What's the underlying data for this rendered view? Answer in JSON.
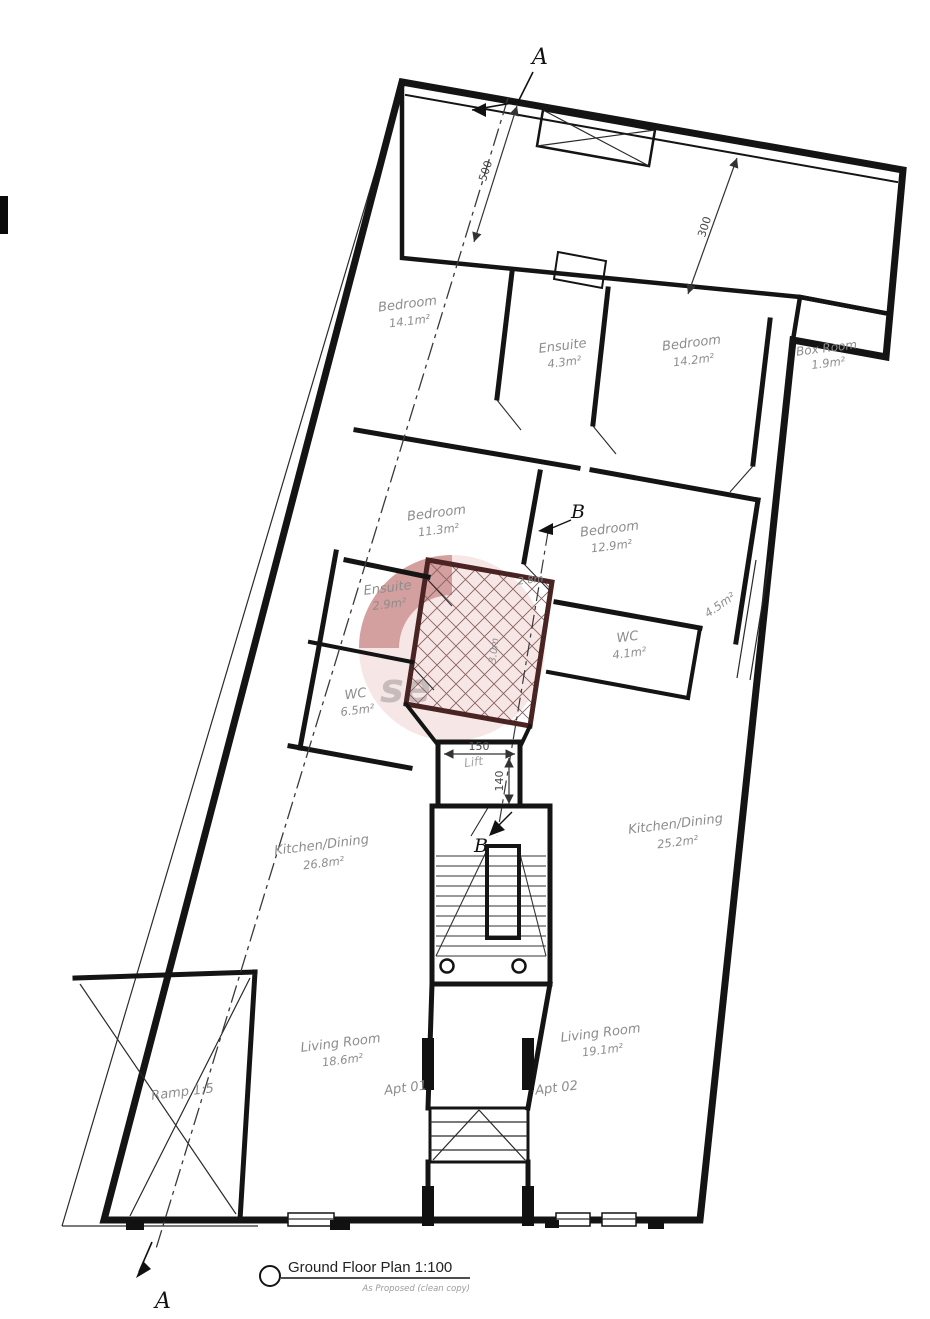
{
  "title": {
    "label": "Ground Floor Plan 1:100",
    "subtitle": "As Proposed (clean copy)"
  },
  "sections": {
    "a_top": "A",
    "a_bottom": "A",
    "b_top": "B",
    "b_bottom": "B"
  },
  "rooms": [
    {
      "name": "Bedroom",
      "area": "14.1m²"
    },
    {
      "name": "Ensuite",
      "area": "4.3m²"
    },
    {
      "name": "Bedroom",
      "area": "14.2m²"
    },
    {
      "name": "Box Room",
      "area": "1.9m²"
    },
    {
      "name": "Bedroom",
      "area": "11.3m²"
    },
    {
      "name": "Bedroom",
      "area": "12.9m²"
    },
    {
      "name": "Ensuite",
      "area": "2.9m²"
    },
    {
      "name": "WC",
      "area": "4.1m²"
    },
    {
      "name": "",
      "area": "4.5m²"
    },
    {
      "name": "WC",
      "area": "6.5m²"
    },
    {
      "name": "Lift",
      "area": ""
    },
    {
      "name": "Kitchen/Dining",
      "area": "26.8m²"
    },
    {
      "name": "Kitchen/Dining",
      "area": "25.2m²"
    },
    {
      "name": "Living Room",
      "area": "18.6m²"
    },
    {
      "name": "Living Room",
      "area": "19.1m²"
    },
    {
      "name": "Ramp 1:5",
      "area": ""
    },
    {
      "name": "Apt 01",
      "area": ""
    },
    {
      "name": "Apt 02",
      "area": ""
    }
  ],
  "dimensions": {
    "top_left": "500",
    "top_right": "300",
    "lift_width": "150",
    "lift_depth": "140",
    "shaft_top": "2.8m",
    "shaft_side": "3.0m"
  },
  "watermark": {
    "text": "se",
    "accent_color": "#9b2d2d"
  }
}
